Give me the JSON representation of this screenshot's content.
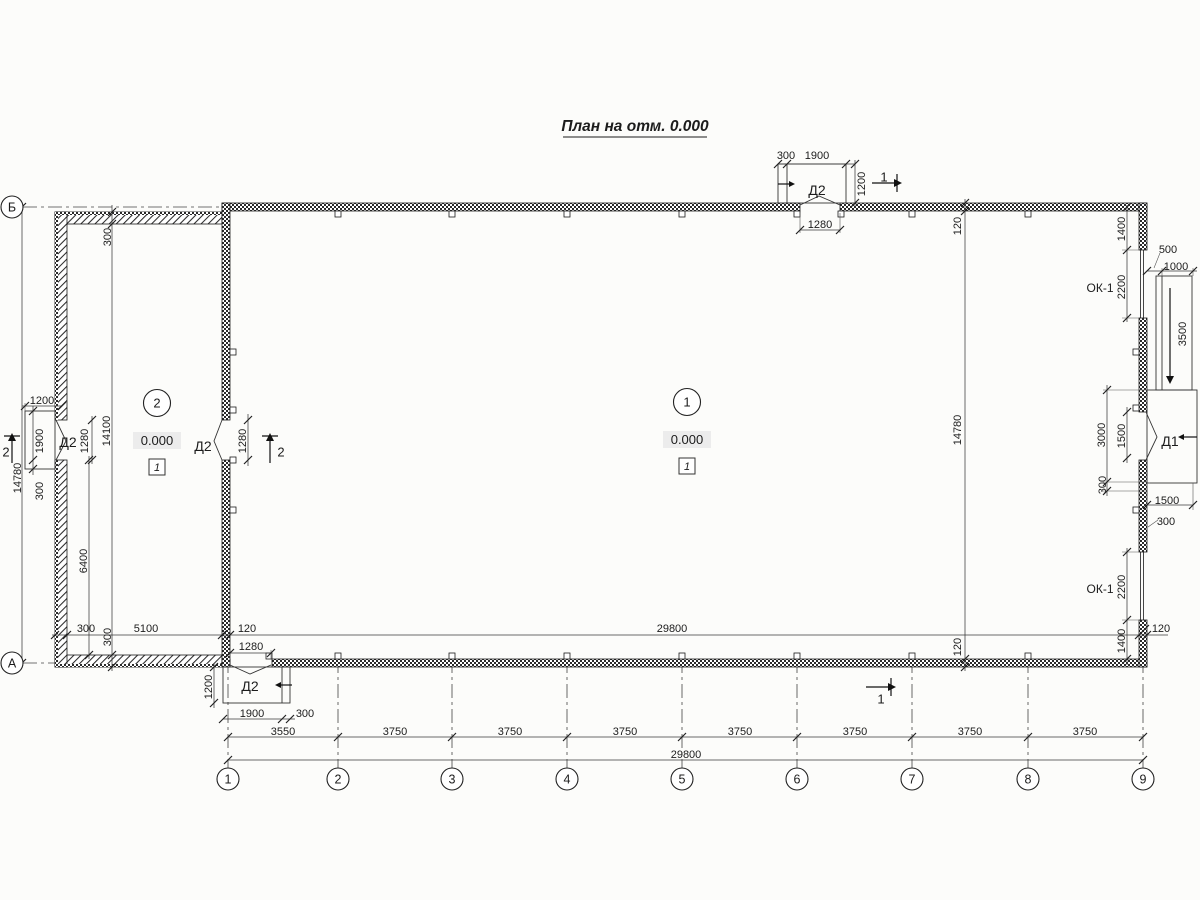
{
  "title": {
    "text": "План на отм. 0.000"
  },
  "grid": {
    "cols": [
      {
        "label": "1",
        "x": 228
      },
      {
        "label": "2",
        "x": 338
      },
      {
        "label": "3",
        "x": 452
      },
      {
        "label": "4",
        "x": 567
      },
      {
        "label": "5",
        "x": 682
      },
      {
        "label": "6",
        "x": 797
      },
      {
        "label": "7",
        "x": 912
      },
      {
        "label": "8",
        "x": 1028
      },
      {
        "label": "9",
        "x": 1143
      }
    ],
    "rows": [
      {
        "label": "Б",
        "y": 207
      },
      {
        "label": "А",
        "y": 663
      }
    ]
  },
  "rooms": [
    {
      "number": "1",
      "level": "0.000",
      "floor_type": "1",
      "cx": 687,
      "cy": 402
    },
    {
      "number": "2",
      "level": "0.000",
      "floor_type": "1",
      "cx": 157,
      "cy": 403
    }
  ],
  "texts": [
    {
      "n": "dim-300-top-door",
      "t": "300",
      "x": 786,
      "y": 155
    },
    {
      "n": "dim-1900-top-door",
      "t": "1900",
      "x": 817,
      "y": 155
    },
    {
      "n": "dim-1200-top-door",
      "t": "1200",
      "x": 861,
      "y": 184,
      "r": 1
    },
    {
      "n": "door-label-d2-top",
      "t": "Д2",
      "x": 817,
      "y": 190,
      "c": "door"
    },
    {
      "n": "dim-1280-top-door",
      "t": "1280",
      "x": 820,
      "y": 224
    },
    {
      "n": "section-mark-1-top",
      "t": "1",
      "x": 884,
      "y": 177,
      "c": "sec"
    },
    {
      "n": "dim-120-top-wall",
      "t": "120",
      "x": 957,
      "y": 226,
      "r": 1
    },
    {
      "n": "dim-14780-interior",
      "t": "14780",
      "x": 957,
      "y": 430,
      "r": 1
    },
    {
      "n": "dim-120-bottom-wall",
      "t": "120",
      "x": 957,
      "y": 647,
      "r": 1
    },
    {
      "n": "dim-1400-window-top",
      "t": "1400",
      "x": 1121,
      "y": 229,
      "r": 1
    },
    {
      "n": "dim-500-ramp",
      "t": "500",
      "x": 1168,
      "y": 249
    },
    {
      "n": "dim-1000-ramp",
      "t": "1000",
      "x": 1176,
      "y": 266
    },
    {
      "n": "window-label-ok1-top",
      "t": "ОК-1",
      "x": 1100,
      "y": 288,
      "c": "ok"
    },
    {
      "n": "dim-2200-window-top",
      "t": "2200",
      "x": 1121,
      "y": 287,
      "r": 1
    },
    {
      "n": "dim-3500-ramp",
      "t": "3500",
      "x": 1182,
      "y": 334,
      "r": 1
    },
    {
      "n": "dim-3000-door-d1",
      "t": "3000",
      "x": 1101,
      "y": 435,
      "r": 1
    },
    {
      "n": "dim-1500-door-d1",
      "t": "1500",
      "x": 1121,
      "y": 436,
      "r": 1
    },
    {
      "n": "door-label-d1",
      "t": "Д1",
      "x": 1170,
      "y": 441,
      "c": "door"
    },
    {
      "n": "dim-300-door-d1",
      "t": "300",
      "x": 1102,
      "y": 485,
      "r": 1
    },
    {
      "n": "dim-1500-porch-d1",
      "t": "1500",
      "x": 1167,
      "y": 500
    },
    {
      "n": "dim-300-porch-d1",
      "t": "300",
      "x": 1166,
      "y": 521
    },
    {
      "n": "window-label-ok1-bottom",
      "t": "ОК-1",
      "x": 1100,
      "y": 589,
      "c": "ok"
    },
    {
      "n": "dim-2200-window-bottom",
      "t": "2200",
      "x": 1121,
      "y": 587,
      "r": 1
    },
    {
      "n": "dim-1400-window-bottom",
      "t": "1400",
      "x": 1121,
      "y": 641,
      "r": 1
    },
    {
      "n": "dim-300-annex-top-wall",
      "t": "300",
      "x": 107,
      "y": 237,
      "r": 1
    },
    {
      "n": "dim-1200-porch-left",
      "t": "1200",
      "x": 42,
      "y": 400
    },
    {
      "n": "section-mark-2-left",
      "t": "2",
      "x": 6,
      "y": 452,
      "c": "sec"
    },
    {
      "n": "dim-1900-porch-left",
      "t": "1900",
      "x": 39,
      "y": 441,
      "r": 1
    },
    {
      "n": "door-label-d2-left",
      "t": "Д2",
      "x": 68,
      "y": 442,
      "c": "door"
    },
    {
      "n": "dim-1280-door-left",
      "t": "1280",
      "x": 84,
      "y": 441,
      "r": 1
    },
    {
      "n": "dim-14100-annex",
      "t": "14100",
      "x": 106,
      "y": 431,
      "r": 1
    },
    {
      "n": "dim-14780-left",
      "t": "14780",
      "x": 17,
      "y": 478,
      "r": 1
    },
    {
      "n": "dim-300-porch-left",
      "t": "300",
      "x": 39,
      "y": 491,
      "r": 1
    },
    {
      "n": "dim-6400-annex",
      "t": "6400",
      "x": 83,
      "y": 561,
      "r": 1
    },
    {
      "n": "dim-300-annex-bottom-wall",
      "t": "300",
      "x": 107,
      "y": 637,
      "r": 1
    },
    {
      "n": "door-label-d2-mid",
      "t": "Д2",
      "x": 203,
      "y": 446,
      "c": "door"
    },
    {
      "n": "dim-1280-door-mid",
      "t": "1280",
      "x": 242,
      "y": 441,
      "r": 1
    },
    {
      "n": "section-mark-2-mid",
      "t": "2",
      "x": 281,
      "y": 452,
      "c": "sec"
    },
    {
      "n": "dim-300-annex-width",
      "t": "300",
      "x": 86,
      "y": 628
    },
    {
      "n": "dim-5100-annex-width",
      "t": "5100",
      "x": 146,
      "y": 628
    },
    {
      "n": "dim-120-partition",
      "t": "120",
      "x": 247,
      "y": 628
    },
    {
      "n": "dim-29800-interior",
      "t": "29800",
      "x": 672,
      "y": 628
    },
    {
      "n": "dim-120-right-wall",
      "t": "120",
      "x": 1161,
      "y": 628
    },
    {
      "n": "dim-1280-door-bottom",
      "t": "1280",
      "x": 251,
      "y": 646
    },
    {
      "n": "door-label-d2-bottom",
      "t": "Д2",
      "x": 250,
      "y": 686,
      "c": "door"
    },
    {
      "n": "dim-1200-porch-bottom",
      "t": "1200",
      "x": 208,
      "y": 687,
      "r": 1
    },
    {
      "n": "dim-1900-porch-bottom",
      "t": "1900",
      "x": 252,
      "y": 713
    },
    {
      "n": "dim-300-porch-bottom",
      "t": "300",
      "x": 305,
      "y": 713
    },
    {
      "n": "section-mark-1-bottom",
      "t": "1",
      "x": 881,
      "y": 699,
      "c": "sec"
    },
    {
      "n": "dim-3550-bay",
      "t": "3550",
      "x": 283,
      "y": 731
    },
    {
      "n": "dim-3750-bay",
      "t": "3750",
      "x": 395,
      "y": 731
    },
    {
      "n": "dim-3750-bay",
      "t": "3750",
      "x": 510,
      "y": 731
    },
    {
      "n": "dim-3750-bay",
      "t": "3750",
      "x": 625,
      "y": 731
    },
    {
      "n": "dim-3750-bay",
      "t": "3750",
      "x": 740,
      "y": 731
    },
    {
      "n": "dim-3750-bay",
      "t": "3750",
      "x": 855,
      "y": 731
    },
    {
      "n": "dim-3750-bay",
      "t": "3750",
      "x": 970,
      "y": 731
    },
    {
      "n": "dim-3750-bay",
      "t": "3750",
      "x": 1085,
      "y": 731
    },
    {
      "n": "dim-29800-overall",
      "t": "29800",
      "x": 686,
      "y": 754
    }
  ]
}
